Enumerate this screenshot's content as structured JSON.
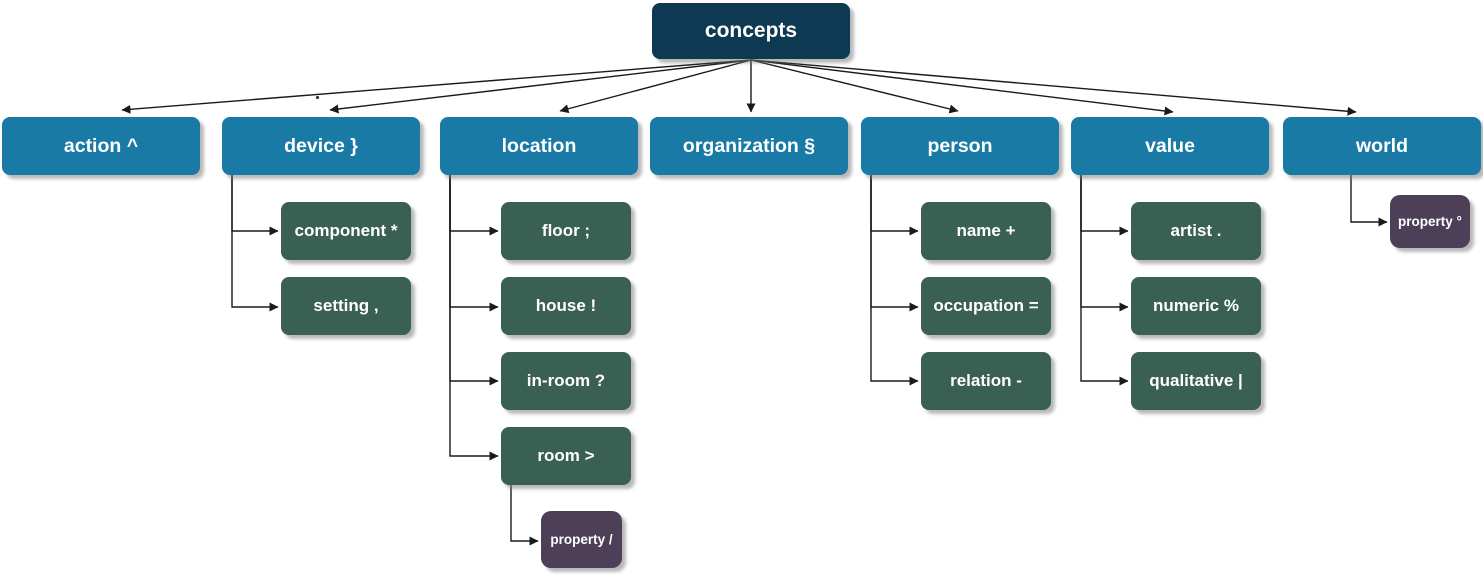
{
  "colors": {
    "root": "#0d3a52",
    "category": "#1a7aa6",
    "subcategory": "#3a5f53",
    "property": "#4c3f57",
    "node-text": "#ffffff",
    "edge": "#1a1a1a"
  },
  "nodes": {
    "concepts": "concepts",
    "action": "action ^",
    "device": "device }",
    "location": "location",
    "organization": "organization §",
    "person": "person",
    "value": "value",
    "world": "world",
    "component": "component *",
    "setting": "setting ,",
    "in_room": "in-room ?",
    "floor": "floor ;",
    "house": "house !",
    "room": "room >",
    "room_property": "property /",
    "name": "name +",
    "occupation": "occupation =",
    "relation": "relation -",
    "artist": "artist .",
    "numeric": "numeric %",
    "qualitative": "qualitative |",
    "world_property": "property °"
  },
  "edge_label": ".",
  "edges": [
    [
      "concepts",
      "action"
    ],
    [
      "concepts",
      "device"
    ],
    [
      "concepts",
      "location"
    ],
    [
      "concepts",
      "organization"
    ],
    [
      "concepts",
      "person"
    ],
    [
      "concepts",
      "value"
    ],
    [
      "concepts",
      "world"
    ],
    [
      "device",
      "component"
    ],
    [
      "device",
      "setting"
    ],
    [
      "location",
      "floor"
    ],
    [
      "location",
      "house"
    ],
    [
      "location",
      "in-room"
    ],
    [
      "location",
      "room"
    ],
    [
      "room",
      "property /"
    ],
    [
      "person",
      "name"
    ],
    [
      "person",
      "occupation"
    ],
    [
      "person",
      "relation"
    ],
    [
      "value",
      "artist"
    ],
    [
      "value",
      "numeric"
    ],
    [
      "value",
      "qualitative"
    ],
    [
      "world",
      "property °"
    ]
  ]
}
